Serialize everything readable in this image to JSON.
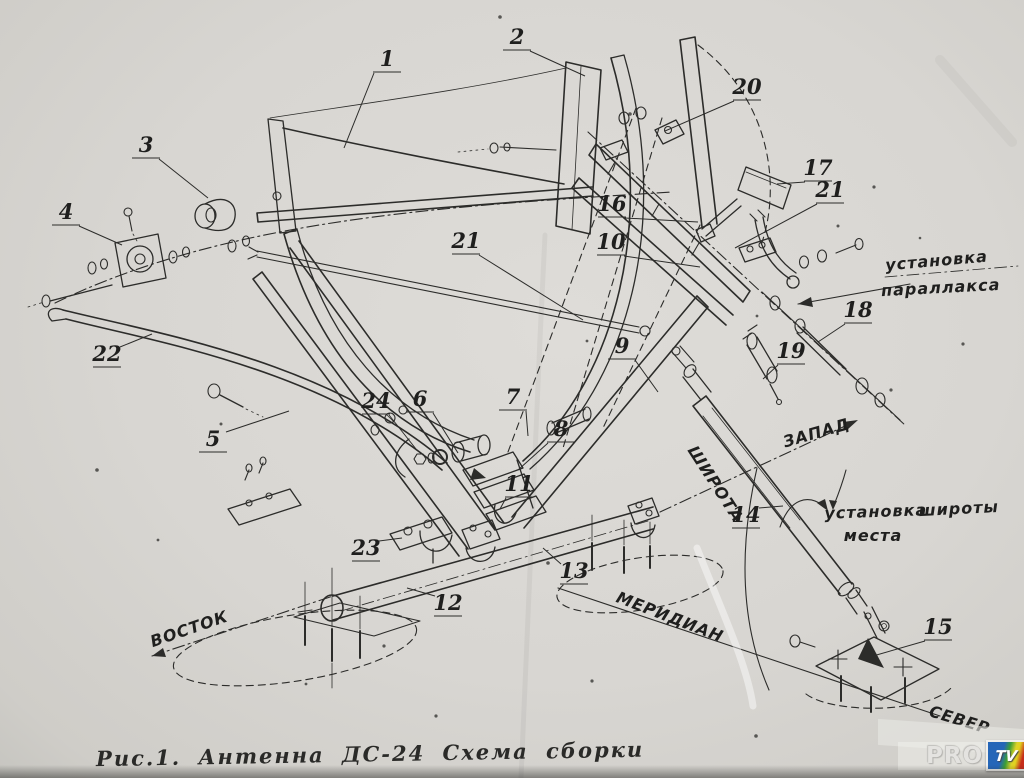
{
  "figure": {
    "caption": "Рис.1.  Антенна ДС-24   Схема сборки",
    "watermark": {
      "pro": "PRO",
      "tv": "TV"
    }
  },
  "colors": {
    "paper": "#d8d6d2",
    "ink": "#2c2c2a",
    "tv_blue": "#2566b8",
    "tv_green": "#3d9e35",
    "tv_yellow": "#ddd229",
    "tv_red": "#c62c1a"
  },
  "callouts": [
    {
      "id": "1",
      "n": "1",
      "x": 387,
      "y": 66,
      "lx": 344,
      "ly": 148
    },
    {
      "id": "2",
      "n": "2",
      "x": 517,
      "y": 44,
      "lx": 585,
      "ly": 76
    },
    {
      "id": "3",
      "n": "3",
      "x": 146,
      "y": 152,
      "lx": 208,
      "ly": 198
    },
    {
      "id": "4",
      "n": "4",
      "x": 66,
      "y": 219,
      "lx": 122,
      "ly": 245
    },
    {
      "id": "5",
      "n": "5",
      "x": 213,
      "y": 446,
      "lx": 289,
      "ly": 411
    },
    {
      "id": "6",
      "n": "6",
      "x": 420,
      "y": 406,
      "lx": 458,
      "ly": 453
    },
    {
      "id": "7",
      "n": "7",
      "x": 513,
      "y": 404,
      "lx": 528,
      "ly": 436
    },
    {
      "id": "8",
      "n": "8",
      "x": 561,
      "y": 436,
      "lx": 518,
      "ly": 470
    },
    {
      "id": "9",
      "n": "9",
      "x": 622,
      "y": 353,
      "lx": 658,
      "ly": 392
    },
    {
      "id": "10",
      "n": "10",
      "x": 611,
      "y": 249,
      "lx": 700,
      "ly": 267
    },
    {
      "id": "11",
      "n": "11",
      "x": 519,
      "y": 491,
      "lx": 500,
      "ly": 509
    },
    {
      "id": "12",
      "n": "12",
      "x": 448,
      "y": 610,
      "lx": 407,
      "ly": 588
    },
    {
      "id": "13",
      "n": "13",
      "x": 574,
      "y": 578,
      "lx": 543,
      "ly": 548
    },
    {
      "id": "14",
      "n": "14",
      "x": 746,
      "y": 522,
      "lx": 783,
      "ly": 506
    },
    {
      "id": "15",
      "n": "15",
      "x": 938,
      "y": 634,
      "lx": 873,
      "ly": 656
    },
    {
      "id": "16",
      "n": "16",
      "x": 612,
      "y": 211,
      "lx": 698,
      "ly": 222
    },
    {
      "id": "17",
      "n": "17",
      "x": 818,
      "y": 175,
      "lx": 777,
      "ly": 184
    },
    {
      "id": "18",
      "n": "18",
      "x": 858,
      "y": 317,
      "lx": 818,
      "ly": 342
    },
    {
      "id": "19",
      "n": "19",
      "x": 791,
      "y": 358,
      "lx": 763,
      "ly": 379
    },
    {
      "id": "20",
      "n": "20",
      "x": 747,
      "y": 94,
      "lx": 665,
      "ly": 131
    },
    {
      "id": "21-left",
      "n": "21",
      "x": 466,
      "y": 248,
      "lx": 583,
      "ly": 320
    },
    {
      "id": "21-right",
      "n": "21",
      "x": 830,
      "y": 197,
      "lx": 735,
      "ly": 248
    },
    {
      "id": "22",
      "n": "22",
      "x": 107,
      "y": 361,
      "lx": 152,
      "ly": 334
    },
    {
      "id": "23",
      "n": "23",
      "x": 366,
      "y": 555,
      "lx": 402,
      "ly": 538
    },
    {
      "id": "24",
      "n": "24",
      "x": 376,
      "y": 408,
      "lx": 416,
      "ly": 449
    }
  ],
  "labels": [
    {
      "id": "ustanovka-parallaksa-1",
      "text": "установка",
      "x": 937,
      "y": 266,
      "rot": -5,
      "size": 16
    },
    {
      "id": "ustanovka-parallaksa-2",
      "text": "параллакса",
      "x": 941,
      "y": 293,
      "rot": -3,
      "size": 16
    },
    {
      "id": "ustanovka-shiroty-1",
      "text": "установка",
      "x": 876,
      "y": 517,
      "rot": -2,
      "size": 16
    },
    {
      "id": "ustanovka-shiroty-2",
      "text": "широты",
      "x": 959,
      "y": 514,
      "rot": -3,
      "size": 16
    },
    {
      "id": "ustanovka-shiroty-3",
      "text": "места",
      "x": 873,
      "y": 541,
      "rot": 0,
      "size": 16
    },
    {
      "id": "zapad",
      "text": "ЗАПАД",
      "x": 818,
      "y": 438,
      "rot": -16,
      "size": 15
    },
    {
      "id": "vostok",
      "text": "ВОСТОК",
      "x": 191,
      "y": 634,
      "rot": -19,
      "size": 15
    },
    {
      "id": "meridian",
      "text": "МЕРИДИАН",
      "x": 668,
      "y": 622,
      "rot": 21,
      "size": 15
    },
    {
      "id": "sever",
      "text": "СЕВЕР",
      "x": 958,
      "y": 725,
      "rot": 17,
      "size": 15
    },
    {
      "id": "shirota",
      "text": "ШИРОТА",
      "x": 711,
      "y": 487,
      "rot": 57,
      "size": 15
    }
  ]
}
